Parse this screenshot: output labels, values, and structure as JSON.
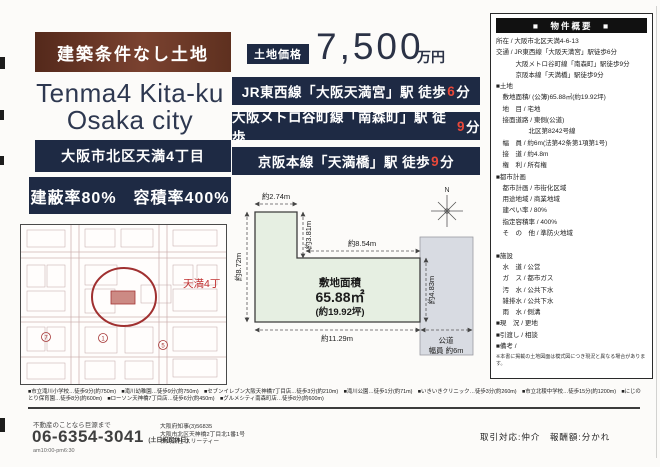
{
  "header": {
    "banner": "建築条件なし土地",
    "title_en_line1": "Tenma4 Kita-ku",
    "title_en_line2": "Osaka city",
    "address_badge": "大阪市北区天満4丁目",
    "ratio_badge": "建蔽率80%　容積率400%"
  },
  "price": {
    "label": "土地価格",
    "amount": "7,500",
    "unit": "万円"
  },
  "access": [
    {
      "pre": "JR東西線「大阪天満宮」駅 徒歩",
      "minutes": "6",
      "post": "分"
    },
    {
      "pre": "大阪メトロ谷町線「南森町」駅 徒歩",
      "minutes": "9",
      "post": "分"
    },
    {
      "pre": "京阪本線「天満橋」駅 徒歩",
      "minutes": "9",
      "post": "分"
    }
  ],
  "overview": {
    "title": "■　物件概要　■",
    "rows": [
      "所在 / 大阪市北区天満4-6-13",
      "交通 / JR東西線「大阪天満宮」駅徒歩6分",
      "　　　大阪メトロ谷町線「南森町」駅徒歩9分",
      "　　　京阪本線「天満橋」駅徒歩9分",
      "■土地",
      "　敷地面積/ (公簿)65.88㎡(約19.92坪)",
      "　地　目 / 宅地",
      "　接面道路 / 東側(公道)",
      "　　　　　北区第8242号線",
      "　幅　員 / 約6m(法第42条第1項第1号)",
      "　接　道 / 約4.8m",
      "　権　利 / 所有権",
      "■都市計画",
      "　都市計画 / 市街化区域",
      "　用途地域 / 商業地域",
      "　建ぺい率 / 80%",
      "　指定容積率 / 400%",
      "　そ　の　他 / 準防火地域",
      "",
      "■施設",
      "　水　道 / 公営",
      "　ガ　ス / 都市ガス",
      "　汚　水 / 公共下水",
      "　雑排水 / 公共下水",
      "　雨　水 / 側溝",
      "■現　況 / 更地",
      "■引渡し / 相談",
      "■備考 /"
    ],
    "note": "※本書に掲載の土地図面は模式図につき現況と異なる場合があります。"
  },
  "map": {
    "district_label": "天満4丁",
    "markers": [
      "7",
      "1",
      "5"
    ]
  },
  "plot": {
    "area_label": "敷地面積",
    "area_value": "65.88㎡",
    "area_tsubo": "(約19.92坪)",
    "dims": {
      "top": "約2.74m",
      "notch": "約3.81m",
      "mid": "約8.54m",
      "left": "約8.72m",
      "right": "約4.83m",
      "bottom": "約11.29m"
    },
    "road_label_1": "公道",
    "road_label_2": "幅員 約6m",
    "compass_n": "N"
  },
  "facilities": {
    "line1": "■市立滝川小学校…徒歩9分(約750m)　■滝川幼稚園…徒歩9分(約750m)　■セブンイレブン大阪天神橋7丁目店…徒歩3分(約210m)　■滝川公園…徒歩1分(約71m)　■いきいきクリニック…徒歩3分(約260m)　■市立北稜中学校…徒歩15分(約1200m)　■にじの",
    "line2": "とり保育園…徒歩8分(約600m)　■ローソン天神橋7丁目店…徒歩6分(約450m)　■グルメシティ南森町店…徒歩8分(約600m)"
  },
  "footer": {
    "tagline": "不動産のことなら巨源まで",
    "phone": "06-6354-3041",
    "phone_note": "(土日祝定休日)",
    "hours": "am10:00-pm6:30",
    "license": "大阪府知事(3)56835",
    "company_address": "大阪市北区天神橋2丁目北1番1号",
    "company_name": "株式会社 スリーティー",
    "deal_terms": "取引対応:仲介　報酬額:分かれ"
  }
}
